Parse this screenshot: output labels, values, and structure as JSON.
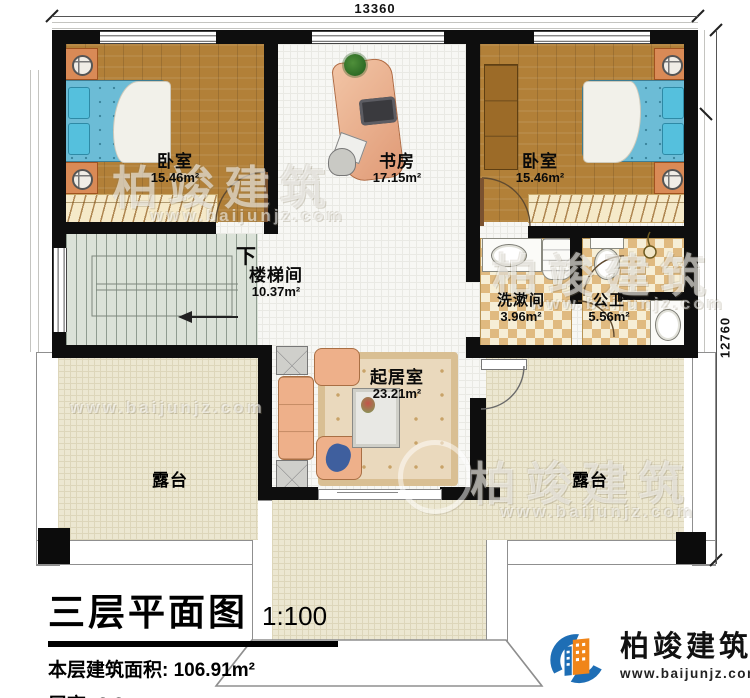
{
  "dimensions": {
    "top": "13360",
    "right": "12760"
  },
  "rooms": {
    "bedroom_left": {
      "name": "卧室",
      "area": "15.46m²"
    },
    "study": {
      "name": "书房",
      "area": "17.15m²"
    },
    "bedroom_right": {
      "name": "卧室",
      "area": "15.46m²"
    },
    "stairwell": {
      "name": "楼梯间",
      "area": "10.37m²",
      "direction": "下"
    },
    "washroom": {
      "name": "洗漱间",
      "area": "3.96m²"
    },
    "toilet": {
      "name": "公卫",
      "area": "5.56m²"
    },
    "living_room": {
      "name": "起居室",
      "area": "23.21m²"
    },
    "terrace_left": {
      "name": "露台"
    },
    "terrace_right": {
      "name": "露台"
    }
  },
  "title_block": {
    "title": "三层平面图",
    "scale": "1:100",
    "area_label": "本层建筑面积:",
    "area_value": "106.91m²",
    "height_label": "层高:",
    "height_value": "3.3m"
  },
  "branding": {
    "company": "柏竣建筑",
    "website": "www.baijunjz.com"
  },
  "watermark": {
    "company": "柏竣建筑",
    "website": "www.baijunjz.com"
  },
  "colors": {
    "wall": "#0e0e0e",
    "wood_floor": "#b28038",
    "bed_blue": "#6cbcd6",
    "terrace": "#ece7d1",
    "logo_blue": "#1e6eb5",
    "logo_orange": "#f08519"
  }
}
